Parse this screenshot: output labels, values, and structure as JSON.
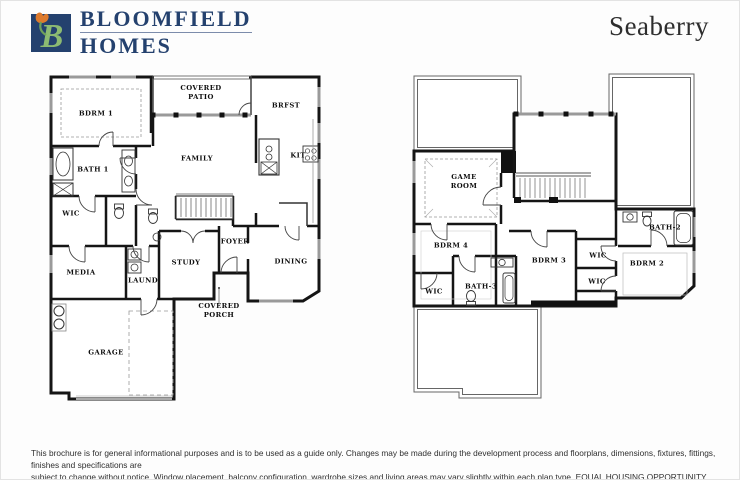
{
  "header": {
    "logo_icon": "bloomfield-homes-b-tulip-logo",
    "brand_line1": "BLOOMFIELD",
    "brand_line2": "HOMES",
    "plan_name": "Seaberry"
  },
  "floor1": {
    "rooms": [
      {
        "label": "BDRM 1"
      },
      {
        "label": "COVERED\nPATIO"
      },
      {
        "label": "BRFST"
      },
      {
        "label": "FAMILY"
      },
      {
        "label": "KIT"
      },
      {
        "label": "BATH 1"
      },
      {
        "label": "WIC"
      },
      {
        "label": "FOYER"
      },
      {
        "label": "STUDY"
      },
      {
        "label": "DINING"
      },
      {
        "label": "MEDIA"
      },
      {
        "label": "LAUND"
      },
      {
        "label": "COVERED\nPORCH"
      },
      {
        "label": "GARAGE"
      }
    ]
  },
  "floor2": {
    "rooms": [
      {
        "label": "GAME\nROOM"
      },
      {
        "label": "BDRM 4"
      },
      {
        "label": "BATH-2"
      },
      {
        "label": "BDRM 3"
      },
      {
        "label": "WIC"
      },
      {
        "label": "BDRM 2"
      },
      {
        "label": "WIC"
      },
      {
        "label": "BATH-3"
      },
      {
        "label": "WIC"
      }
    ]
  },
  "disclaimer": {
    "line1": "This brochure is for general informational purposes and is to be used as a guide only. Changes may be made during the development process and floorplans, dimensions, fixtures, fittings, finishes and specifications are",
    "line2": "subject to change without notice. Window placement, balcony configuration, wardrobe sizes and living areas may vary slightly within each plan type.  EQUAL HOUSING OPPORTUNITY"
  },
  "colors": {
    "brand_navy": "#24416e",
    "wall_black": "#151515",
    "window_gray": "#9a9a9a",
    "leaf_green": "#8cba72",
    "tulip_orange": "#de7b2d"
  }
}
